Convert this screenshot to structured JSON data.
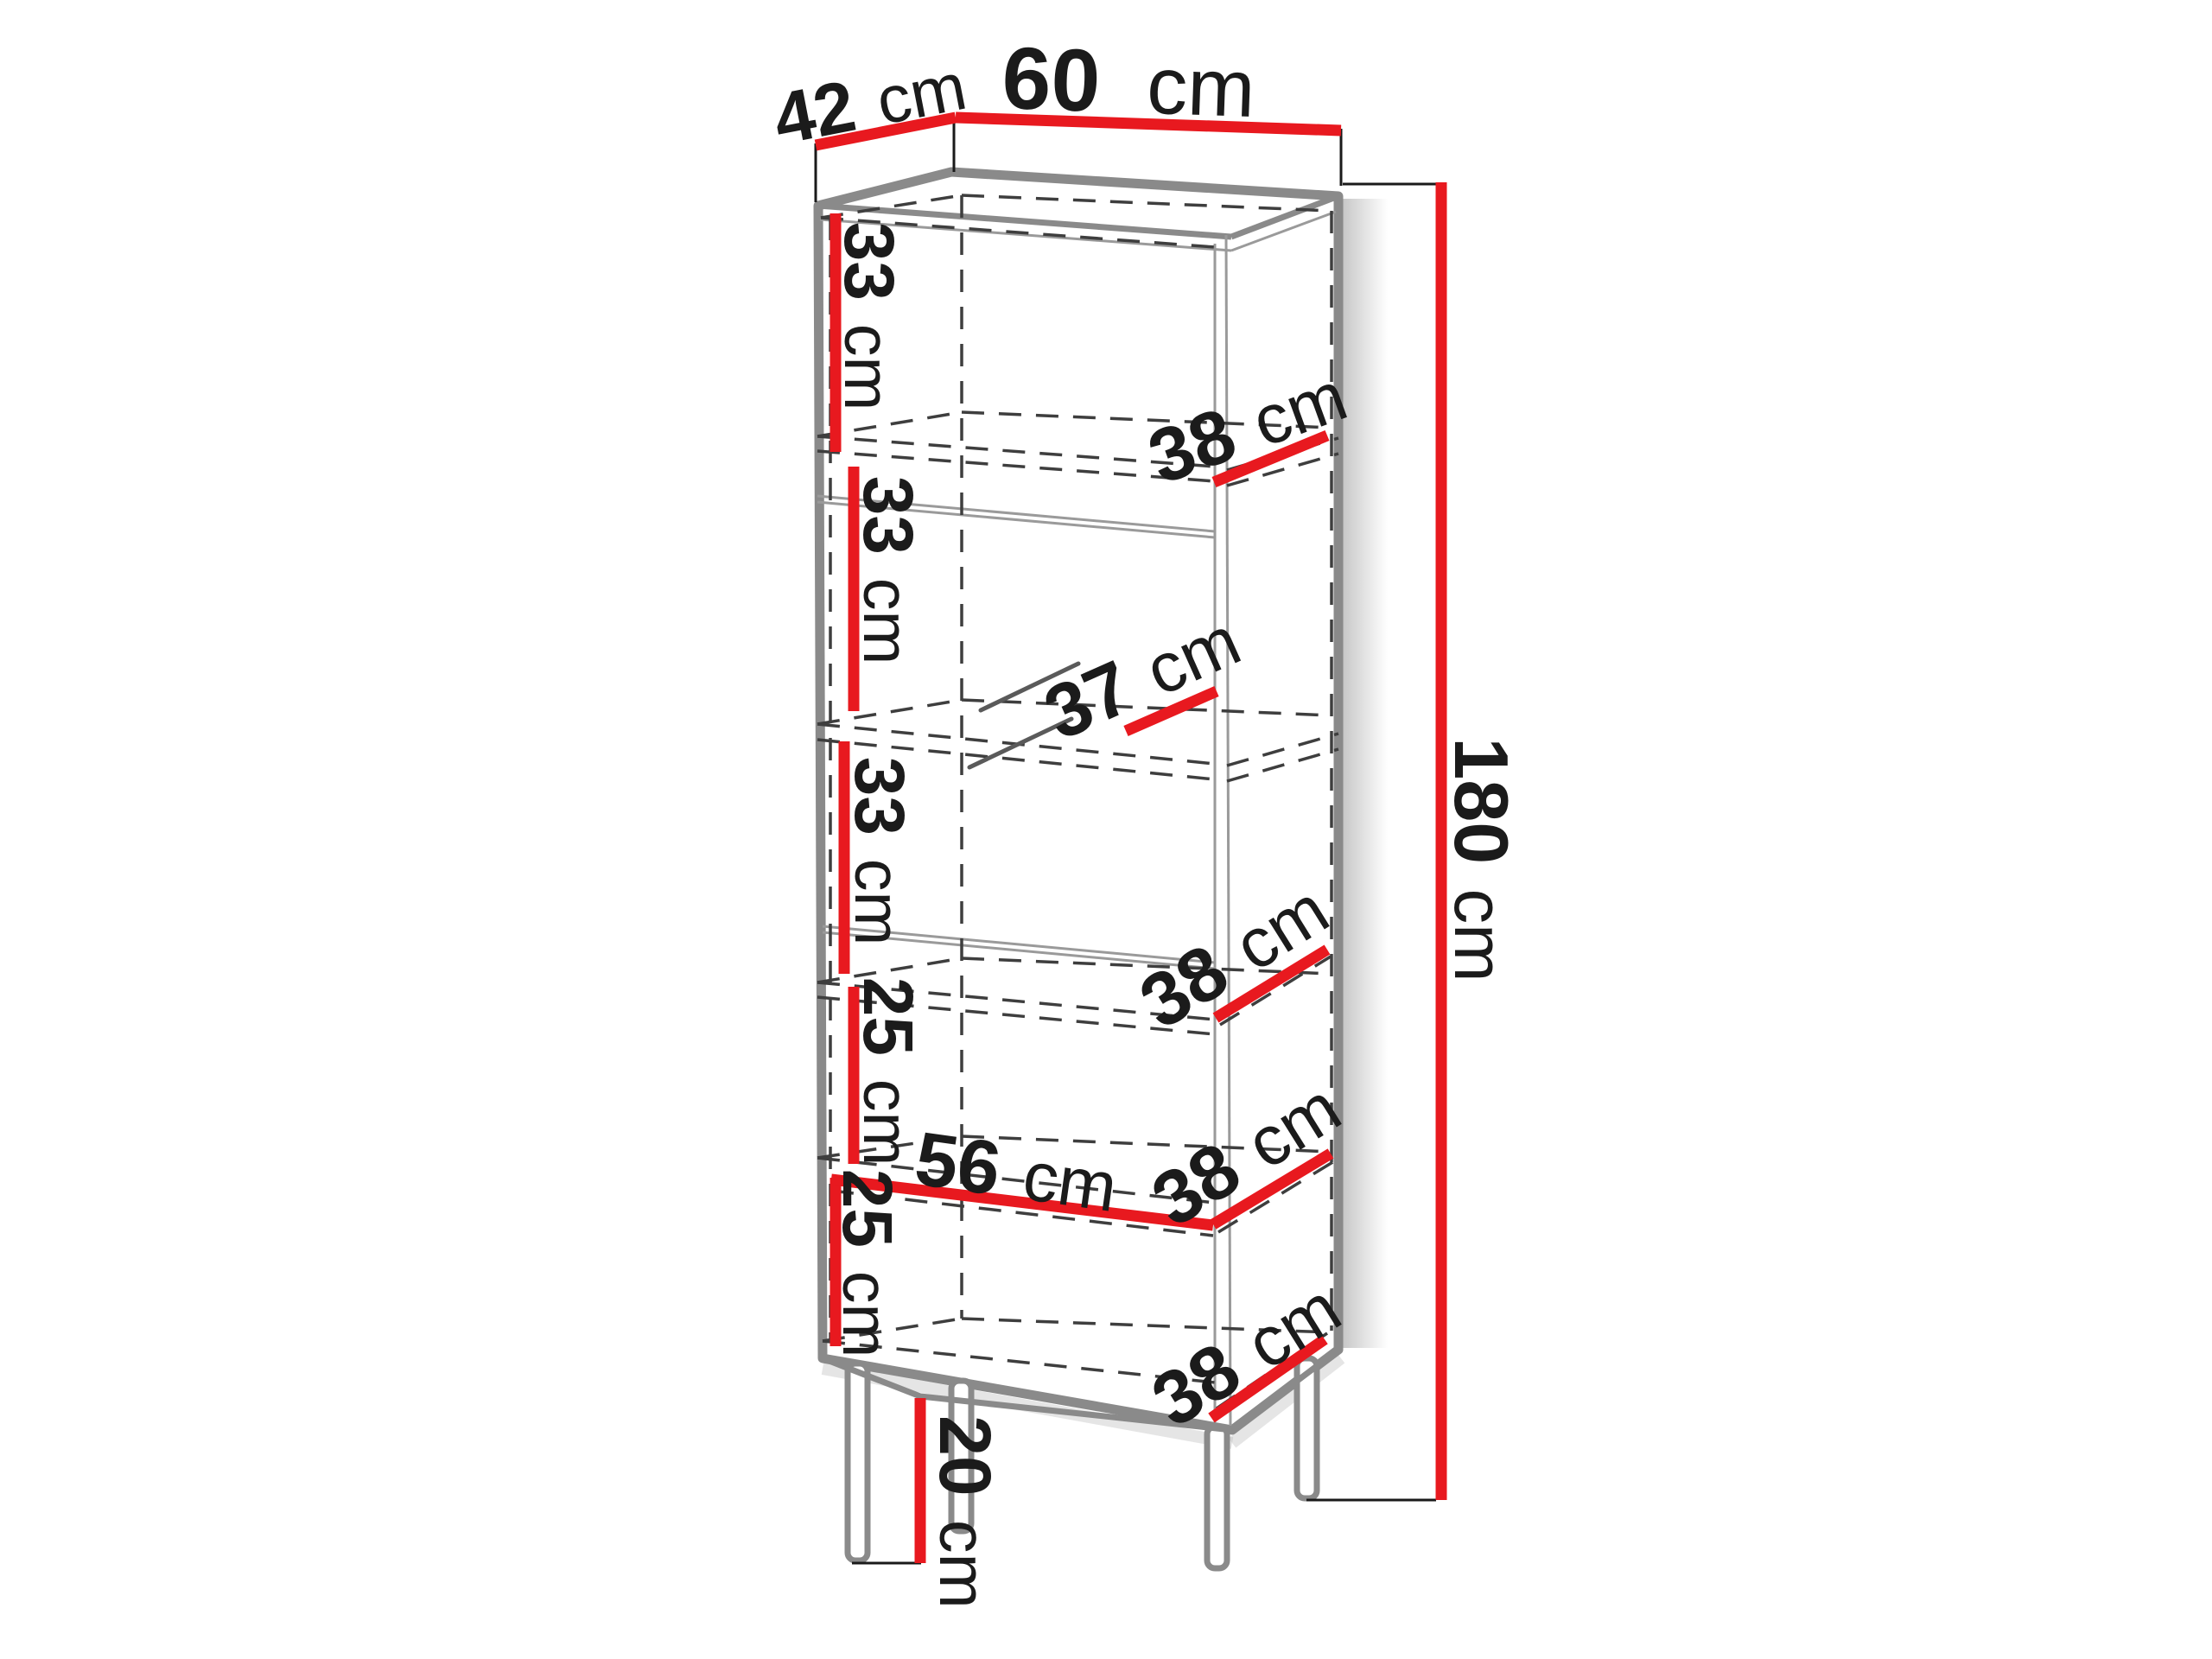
{
  "diagram": {
    "type": "furniture-dimension-diagram",
    "subject": "tall display cabinet with glass door and legs",
    "unit": "cm",
    "colors": {
      "accent_red": "#e8191f",
      "outline_gray": "#8a8a8a",
      "dash_gray": "#3e3e3e",
      "text": "#1b1b1b",
      "background": "#ffffff"
    },
    "overall": {
      "depth_top": {
        "value": "42",
        "unit": "cm"
      },
      "width_top": {
        "value": "60",
        "unit": "cm"
      },
      "height_total": {
        "value": "180",
        "unit": "cm"
      },
      "legs_height": {
        "value": "20",
        "unit": "cm"
      }
    },
    "sections": {
      "section_1_height": {
        "value": "33",
        "unit": "cm"
      },
      "section_2_height": {
        "value": "33",
        "unit": "cm"
      },
      "section_3_height": {
        "value": "33",
        "unit": "cm"
      },
      "section_4_height": {
        "value": "25",
        "unit": "cm"
      },
      "section_5_height": {
        "value": "25",
        "unit": "cm"
      }
    },
    "shelves": {
      "shelf_1_depth": {
        "value": "38",
        "unit": "cm"
      },
      "glass_shelf_depth": {
        "value": "37",
        "unit": "cm"
      },
      "shelf_2_depth": {
        "value": "38",
        "unit": "cm"
      },
      "shelf_3_width": {
        "value": "56",
        "unit": "cm"
      },
      "shelf_3_depth": {
        "value": "38",
        "unit": "cm"
      },
      "base_shelf_depth": {
        "value": "38",
        "unit": "cm"
      }
    }
  }
}
